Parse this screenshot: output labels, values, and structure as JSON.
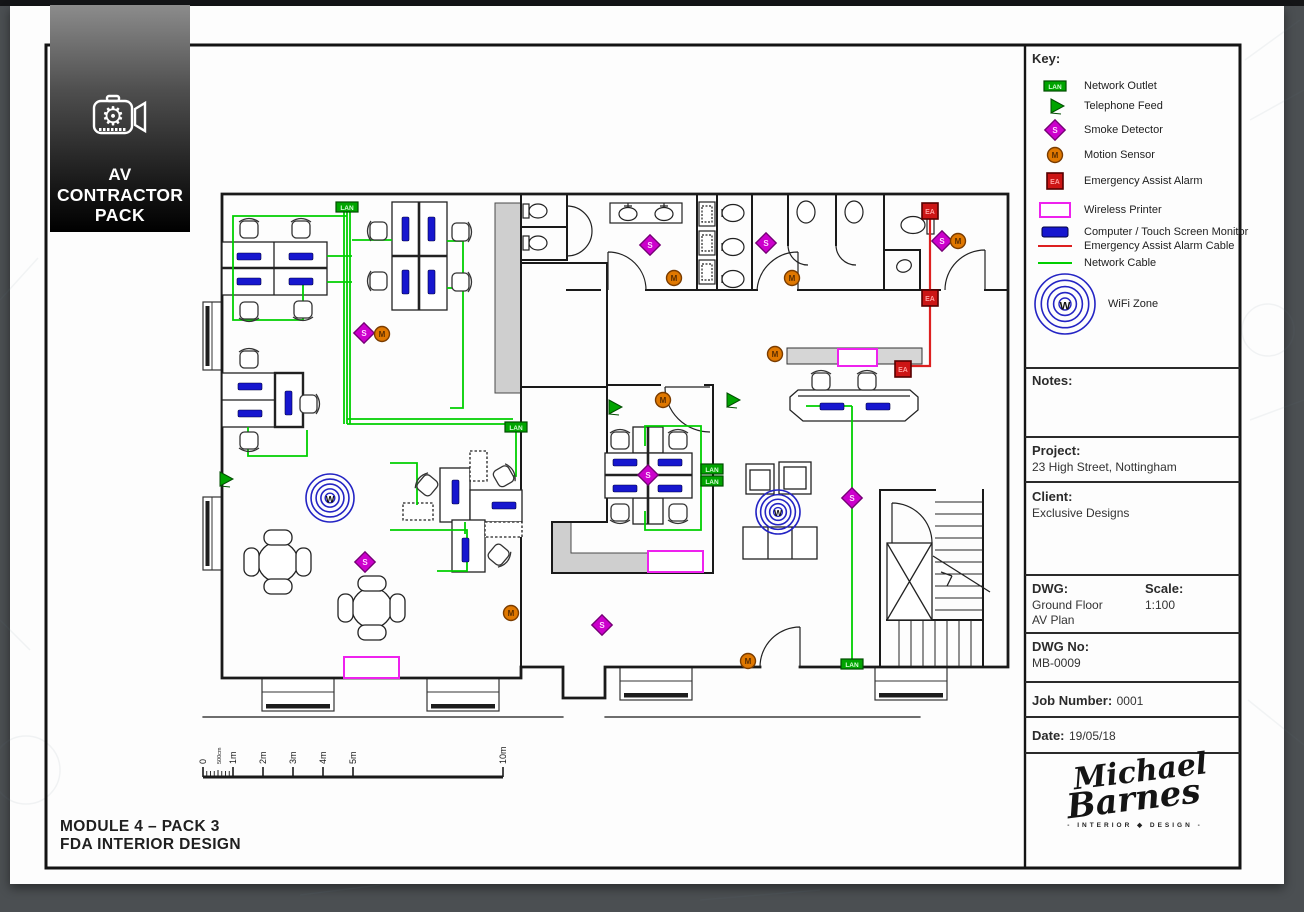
{
  "logo": {
    "line1": "AV",
    "line2": "CONTRACTOR",
    "line3": "PACK"
  },
  "titleblock": {
    "key_title": "Key:",
    "key_items": [
      {
        "symbol": "lan",
        "label": "Network Outlet"
      },
      {
        "symbol": "tel",
        "label": "Telephone Feed"
      },
      {
        "symbol": "smoke",
        "label": "Smoke Detector"
      },
      {
        "symbol": "motion",
        "label": "Motion Sensor"
      },
      {
        "symbol": "ea",
        "label": "Emergency Assist Alarm"
      },
      {
        "symbol": "printer",
        "label": "Wireless Printer"
      },
      {
        "symbol": "monitor",
        "label": "Computer / Touch Screen Monitor"
      },
      {
        "symbol": "cable-red",
        "label": "Emergency Assist Alarm Cable"
      },
      {
        "symbol": "cable-green",
        "label": "Network Cable"
      },
      {
        "symbol": "wifi",
        "label": "WiFi Zone"
      }
    ],
    "notes_label": "Notes:",
    "project_label": "Project:",
    "project_value": "23 High Street, Nottingham",
    "client_label": "Client:",
    "client_value": "Exclusive Designs",
    "dwg_label": "DWG:",
    "dwg_value_line1": "Ground Floor",
    "dwg_value_line2": "AV Plan",
    "scale_label": "Scale:",
    "scale_value": "1:100",
    "dwg_no_label": "DWG No:",
    "dwg_no_value": "MB-0009",
    "job_label": "Job Number:",
    "job_value": "0001",
    "date_label": "Date:",
    "date_value": "19/05/18",
    "signature": {
      "line1": "Michael",
      "line2": "Barnes",
      "sub": "- INTERIOR ◆ DESIGN -"
    }
  },
  "footer": {
    "module_line1": "MODULE 4 – PACK 3",
    "module_line2": "FDA INTERIOR DESIGN"
  },
  "scale_bar": {
    "labels": [
      "0",
      "500cm",
      "1m",
      "2m",
      "3m",
      "4m",
      "5m",
      "10m"
    ],
    "positions": [
      203,
      218,
      233,
      263,
      293,
      323,
      353,
      503
    ]
  },
  "plan": {
    "glyphs": {
      "lan": "LAN",
      "smoke": "S",
      "motion": "M",
      "ea": "EA",
      "wifi": "W"
    },
    "colors": {
      "network": "#00cf00",
      "alarm": "#dd2020",
      "smoke_fill": "#cc00cc",
      "smoke_stroke": "#760076",
      "motion_fill": "#e07800",
      "motion_stroke": "#7a3c00",
      "ea_fill": "#cc1515",
      "ea_stroke": "#550000",
      "printer": "#ee22ee",
      "monitor": "#1717cf",
      "wifi": "#2424c4",
      "lan_fill": "#00a400",
      "lan_stroke": "#004d00"
    },
    "lan_outlets": [
      [
        347,
        207
      ],
      [
        516,
        427
      ],
      [
        712,
        469
      ],
      [
        712,
        481
      ],
      [
        852,
        664
      ]
    ],
    "telephone_feeds": [
      [
        224,
        479
      ],
      [
        613,
        407
      ],
      [
        731,
        400
      ]
    ],
    "smoke_detectors": [
      [
        364,
        333
      ],
      [
        650,
        245
      ],
      [
        766,
        243
      ],
      [
        942,
        241
      ],
      [
        648,
        475
      ],
      [
        852,
        498
      ],
      [
        602,
        625
      ],
      [
        365,
        562
      ]
    ],
    "motion_sensors": [
      [
        382,
        334
      ],
      [
        674,
        278
      ],
      [
        792,
        278
      ],
      [
        958,
        241
      ],
      [
        775,
        354
      ],
      [
        663,
        400
      ],
      [
        748,
        661
      ],
      [
        511,
        613
      ]
    ],
    "ea_alarms": [
      [
        930,
        211
      ],
      [
        930,
        298
      ],
      [
        903,
        369
      ]
    ],
    "wireless_printers": [
      [
        344,
        657,
        55,
        21
      ],
      [
        648,
        551,
        55,
        21
      ],
      [
        838,
        349,
        39,
        17
      ]
    ],
    "wifi_zones": [
      [
        330,
        498,
        24
      ],
      [
        778,
        512,
        22
      ]
    ],
    "monitors": [
      [
        237,
        253,
        "h"
      ],
      [
        289,
        253,
        "h"
      ],
      [
        237,
        278,
        "h"
      ],
      [
        289,
        278,
        "h"
      ],
      [
        402,
        217,
        "v"
      ],
      [
        428,
        217,
        "v"
      ],
      [
        402,
        270,
        "v"
      ],
      [
        428,
        270,
        "v"
      ],
      [
        238,
        383,
        "h"
      ],
      [
        238,
        410,
        "h"
      ],
      [
        285,
        391,
        "v"
      ],
      [
        452,
        480,
        "v"
      ],
      [
        492,
        502,
        "h"
      ],
      [
        462,
        538,
        "v"
      ],
      [
        613,
        459,
        "h"
      ],
      [
        658,
        459,
        "h"
      ],
      [
        613,
        485,
        "h"
      ],
      [
        658,
        485,
        "h"
      ],
      [
        820,
        403,
        "h"
      ],
      [
        866,
        403,
        "h"
      ]
    ],
    "cables": {
      "network": [
        "M344,212 V424",
        "M347,212 V424",
        "M350,212 V424",
        "M347,419 H513",
        "M347,424 H509",
        "M347,216 H233 V320 H303 V284",
        "M327,256 H352",
        "M327,282 H352",
        "M352,240 H392",
        "M447,241 H463 V408 H450",
        "M447,288 H463",
        "M248,427 V456 H307 V430",
        "M516,432 V476 H497",
        "M390,463 H417 V505",
        "M390,530 H467 V571 H437",
        "M465,522 V534",
        "M645,446 V426 H701 V530 H645 V511",
        "M701,469 H709",
        "M701,481 H709",
        "M806,406 H852",
        "M852,406 V659"
      ],
      "alarm": [
        "M930,216 V366 H911"
      ]
    }
  }
}
